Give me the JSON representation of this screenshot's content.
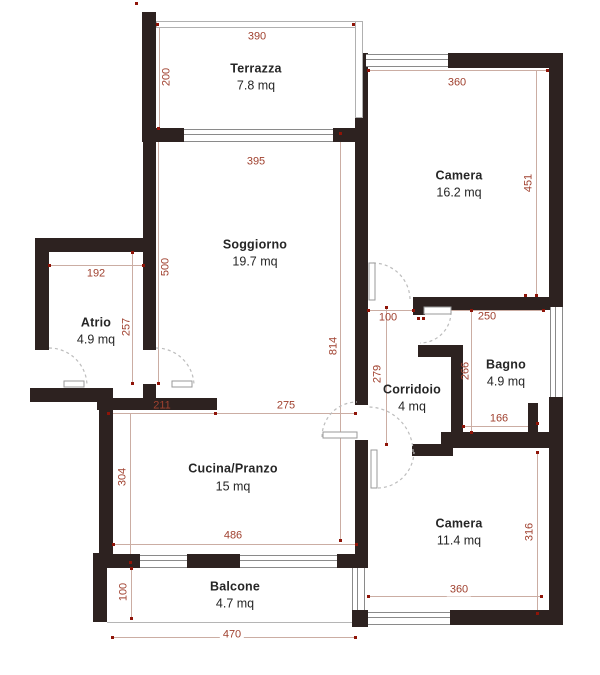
{
  "rooms": {
    "terrazza": {
      "name": "Terrazza",
      "area": "7.8 mq"
    },
    "camera1": {
      "name": "Camera",
      "area": "16.2 mq"
    },
    "soggiorno": {
      "name": "Soggiorno",
      "area": "19.7 mq"
    },
    "atrio": {
      "name": "Atrio",
      "area": "4.9 mq"
    },
    "bagno": {
      "name": "Bagno",
      "area": "4.9 mq"
    },
    "corridoio": {
      "name": "Corridoio",
      "area": "4 mq"
    },
    "cucina": {
      "name": "Cucina/Pranzo",
      "area": "15 mq"
    },
    "camera2": {
      "name": "Camera",
      "area": "11.4 mq"
    },
    "balcone": {
      "name": "Balcone",
      "area": "4.7 mq"
    }
  },
  "dimensions_cm": {
    "terrazza_width": "390",
    "terrazza_depth": "200",
    "soggiorno_width": "395",
    "soggiorno_height": "500",
    "camera1_width": "360",
    "camera1_height": "451",
    "atrio_width": "192",
    "atrio_height": "257",
    "corridoio_opening": "100",
    "bagno_top_width": "250",
    "corridoio_height": "279",
    "bagno_height": "266",
    "left_total_height": "814",
    "bagno_bottom_width": "166",
    "kitchen_wall_left": "211",
    "kitchen_open_span": "275",
    "cucina_height": "304",
    "cucina_width": "486",
    "camera2_height": "316",
    "camera2_width": "360",
    "balcone_depth": "100",
    "balcone_width": "470"
  },
  "colors": {
    "wall": "#2d2220",
    "dim_text": "#a0412f",
    "marker_dot": "#8f1408",
    "dim_line": "#cbada3",
    "window_line": "#8a8a8a",
    "door_arc": "#bdbdbd",
    "room_text": "#262626",
    "background": "#ffffff"
  }
}
